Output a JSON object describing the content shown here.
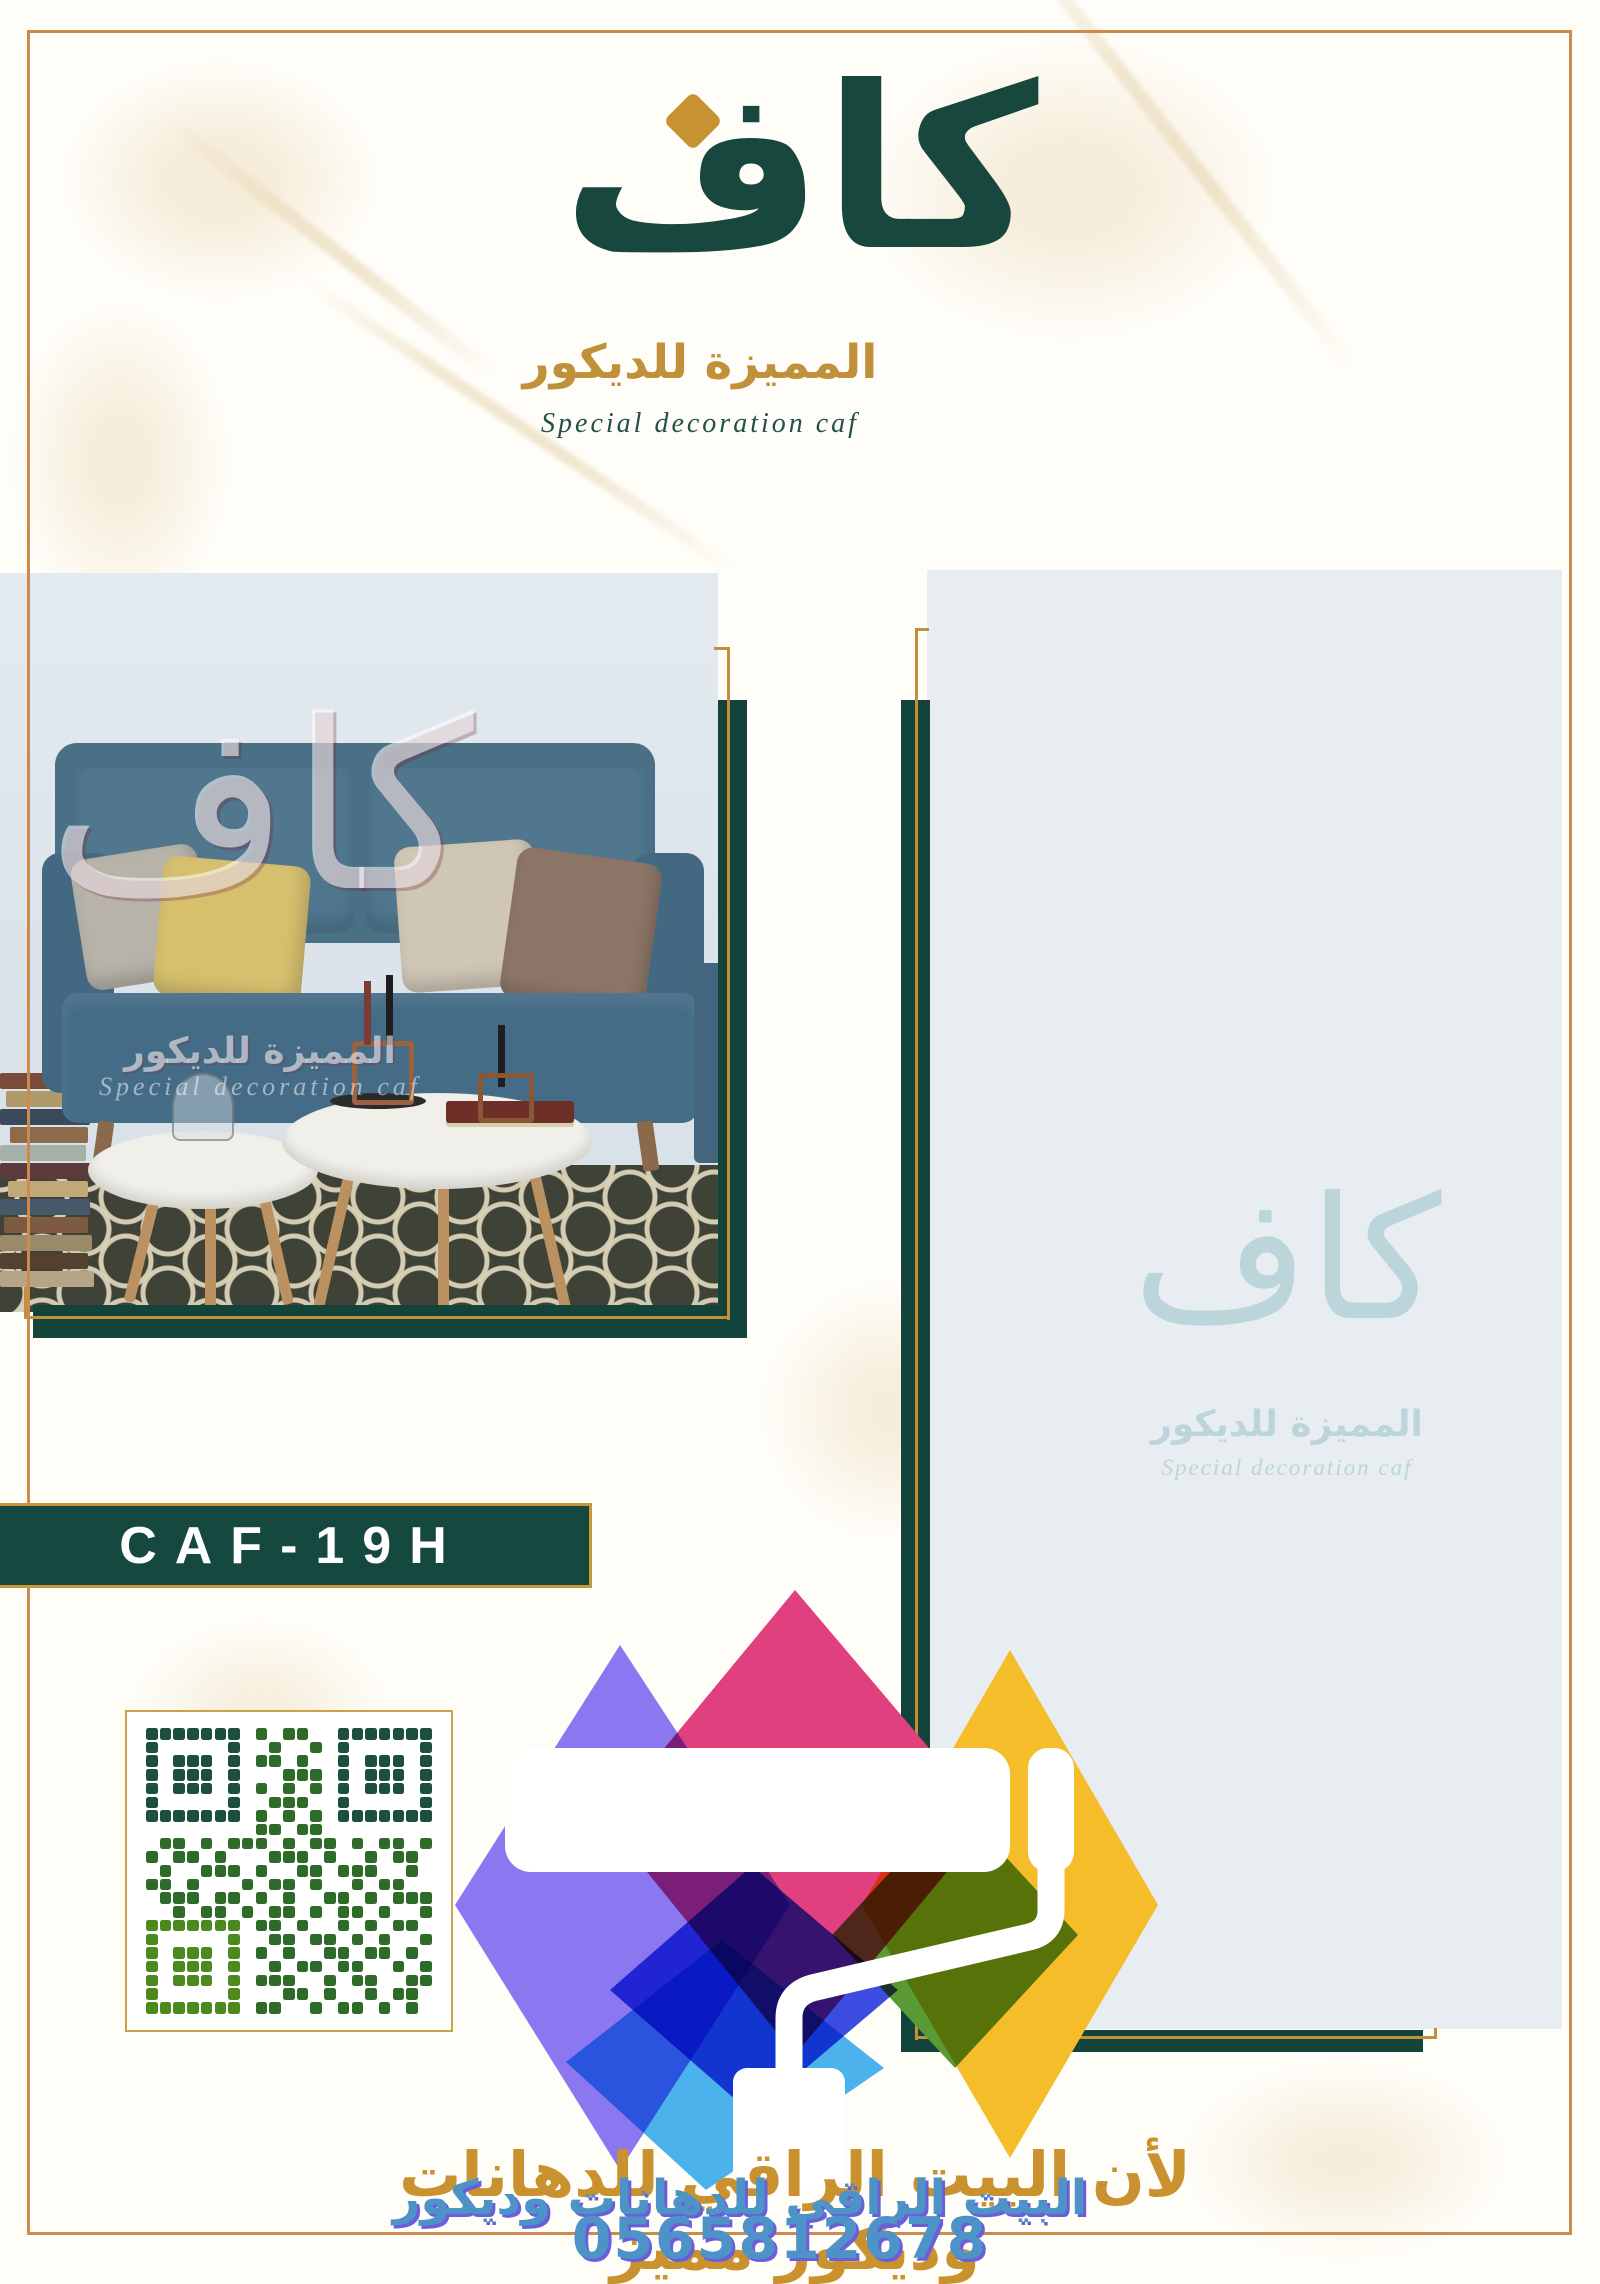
{
  "page": {
    "background": "#fffdf8",
    "border_color": "#cd8a4e",
    "marble_color": "#eadcbd"
  },
  "brand": {
    "kaf_calligraphy": "كاف",
    "arabic_name": "المميزة للديكور",
    "english_name": "Special decoration caf",
    "teal": "#17473d",
    "gold": "#c0903a",
    "diamond_color": "#c69232"
  },
  "product": {
    "code": "CAF-19H",
    "box_color": "#15483f",
    "box_border": "#c9963a"
  },
  "photo_watermark": {
    "kaf": "كاف",
    "arabic_name": "المميزة للديكور",
    "english_name": "Special decoration caf"
  },
  "panel_watermark": {
    "kaf": "كاف",
    "arabic_name": "المميزة للديكور",
    "english_name": "Special decoration caf",
    "color": "#bcd5da"
  },
  "qr": {
    "finder_color": "#1c4f40",
    "finder_bottom_color": "#4d8a1e",
    "module_color": "#2e6b28",
    "matrix": [
      "111111101011001111111",
      "100000100100101000001",
      "101110101101001011101",
      "101110100011101011101",
      "101110101010101011101",
      "100000100111001000001",
      "111111101010101111111",
      "000000001101100000000",
      "011010111010110101101",
      "101101000111010010110",
      "010011101001101110010",
      "110100010110100101100",
      "011101101010011010111",
      "001011010110101101001",
      "111111101101001010110",
      "100000100110110101001",
      "101110101010011011010",
      "101110100101101100101",
      "101110101110010110011",
      "100000100011010010110",
      "111111101100101101010"
    ]
  },
  "paint_logo_colors": {
    "purple": "#8b78f0",
    "pink": "#e0407e",
    "yellow": "#f6bd2a",
    "blue": "#3c4ce0",
    "light_blue": "#4cb2ec",
    "green": "#5a9a33",
    "roller": "#ffffff"
  },
  "frame_colors": {
    "teal": "#12443c",
    "gold": "#c0903a"
  },
  "footer": {
    "gold_text": "لأن البيت الراقي للدهانات وديكور مميز",
    "blue_text": "البيت الراقي للدهانات وديكور",
    "phone": "0565812678",
    "blue": "#4e93c8",
    "gold": "#c9922f"
  }
}
